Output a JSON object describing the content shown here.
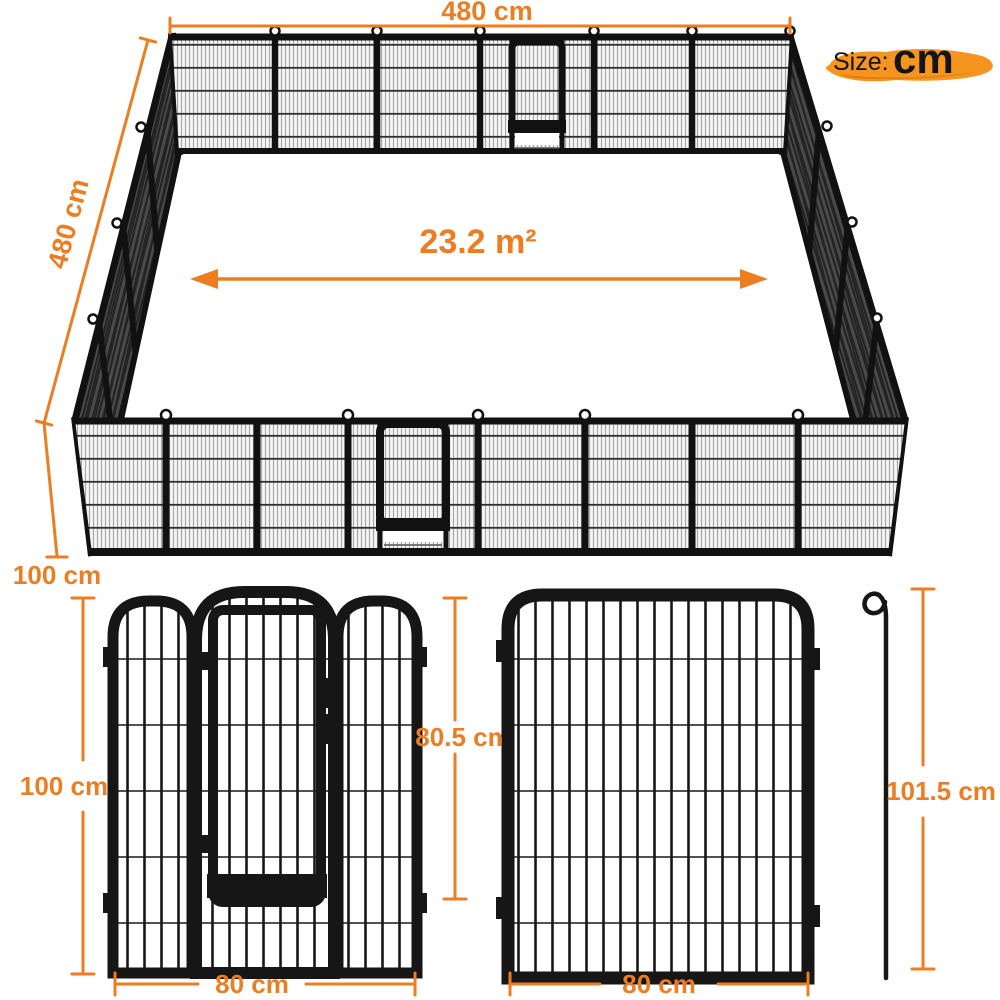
{
  "size_badge": {
    "prefix": "Size:",
    "unit": "cm"
  },
  "colors": {
    "accent_orange": "#EE7D22",
    "brush_orange": "#F5941E",
    "frame_black": "#161616"
  },
  "isometric_view": {
    "width_label": "480 cm",
    "depth_label": "480 cm",
    "height_label": "100 cm",
    "area_label": "23.2 m²"
  },
  "door_panel_view": {
    "height_label": "100 cm",
    "door_height_label": "80.5 cm",
    "width_label": "80 cm"
  },
  "single_panel_view": {
    "height_label": "101.5 cm",
    "width_label": "80 cm"
  }
}
